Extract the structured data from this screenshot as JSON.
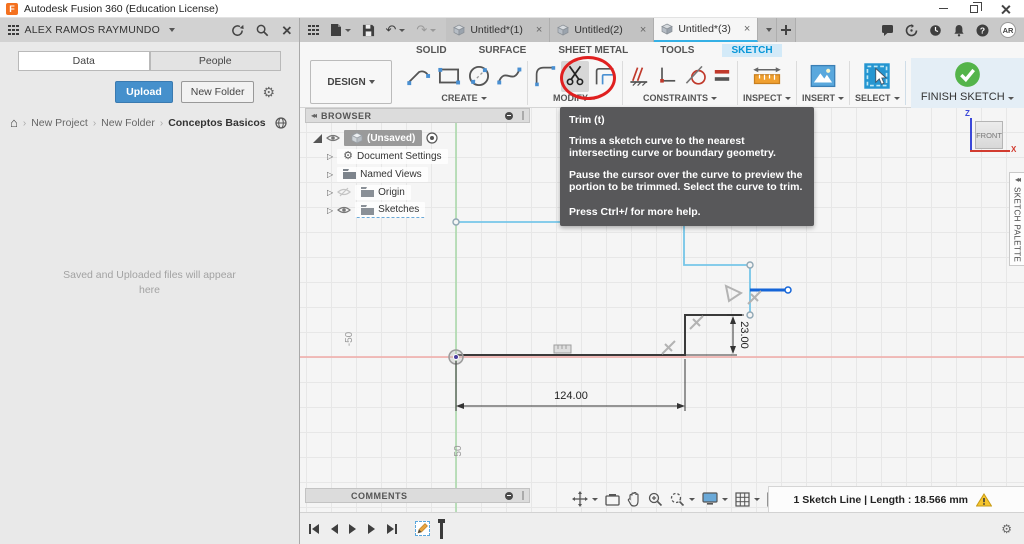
{
  "window": {
    "title": "Autodesk Fusion 360 (Education License)"
  },
  "data_panel": {
    "user_name": "ALEX RAMOS RAYMUNDO",
    "tab_data": "Data",
    "tab_people": "People",
    "upload_label": "Upload",
    "new_folder_label": "New Folder",
    "breadcrumb": [
      "New Project",
      "New Folder",
      "Conceptos Basicos"
    ],
    "empty_state": "Saved and Uploaded files will appear here"
  },
  "doc_tabs": [
    {
      "label": "Untitled*(1)"
    },
    {
      "label": "Untitled(2)"
    },
    {
      "label": "Untitled*(3)"
    }
  ],
  "account": {
    "avatar_initials": "AR"
  },
  "ribbon": {
    "workspace_label": "DESIGN",
    "env_tabs": [
      "SOLID",
      "SURFACE",
      "SHEET METAL",
      "TOOLS",
      "SKETCH"
    ],
    "active_env_tab": "SKETCH",
    "group_create": "CREATE",
    "group_modify": "MODIFY",
    "group_constraints": "CONSTRAINTS",
    "group_inspect": "INSPECT",
    "group_insert": "INSERT",
    "group_select": "SELECT",
    "finish_label": "FINISH SKETCH"
  },
  "tooltip": {
    "title": "Trim (t)",
    "body1": "Trims a sketch curve to the nearest intersecting curve or boundary geometry.",
    "body2": "Pause the cursor over the curve to preview the portion to be trimmed. Select the curve to trim.",
    "footer": "Press Ctrl+/ for more help."
  },
  "browser": {
    "title": "BROWSER",
    "root_label": "(Unsaved)",
    "items": [
      "Document Settings",
      "Named Views",
      "Origin",
      "Sketches"
    ]
  },
  "comments": {
    "title": "COMMENTS"
  },
  "viewcube": {
    "face": "FRONT",
    "axis_z": "Z",
    "axis_x": "X"
  },
  "sketch_palette": {
    "label": "SKETCH PALETTE"
  },
  "sketch": {
    "dim_width": "124.00",
    "dim_height": "23.00",
    "grid_label_neg": "-50",
    "grid_label_pos": "50"
  },
  "status_bar": {
    "message": "1 Sketch Line | Length : 18.566 mm"
  },
  "colors": {
    "accent": "#0696d7",
    "selection": "#1565d8",
    "sketch_line": "#76c6e8",
    "warning": "#f2c230",
    "annotation": "#e02020",
    "finish_green": "#54b44a",
    "axis_x": "#f0aaa6",
    "axis_y": "#abd9ab"
  }
}
